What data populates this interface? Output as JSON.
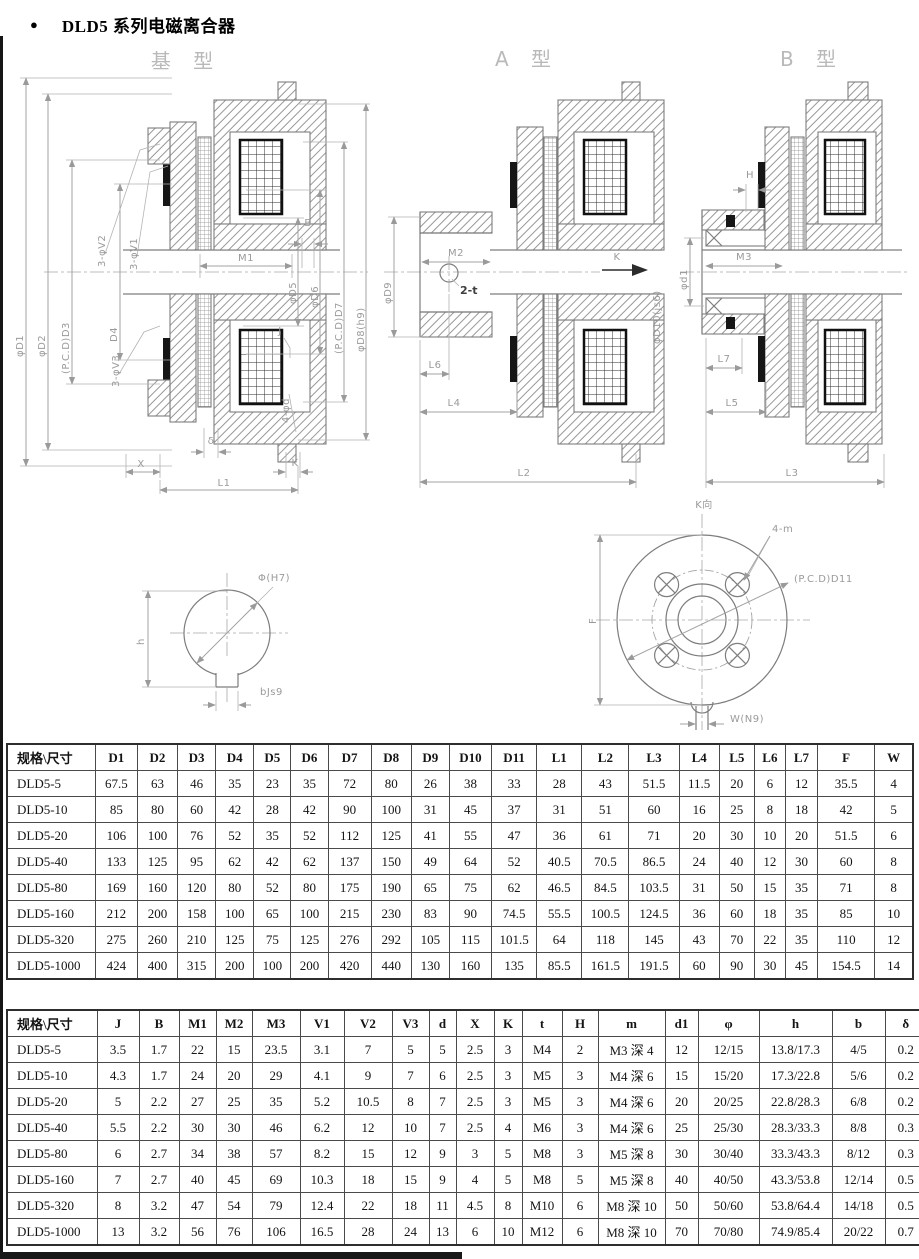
{
  "page": {
    "bullet": "●",
    "title": "DLD5 系列电磁离合器"
  },
  "drawings": {
    "base": {
      "title": "基 型",
      "labels": {
        "phiD1": "φD1",
        "phiD2": "φD2",
        "pcdD3": "(P.C.D)D3",
        "D4": "D4",
        "v2": "3-φV2",
        "v1": "3-φV1",
        "B": "B",
        "M1": "M1",
        "phiD5": "φD5",
        "phiD6": "φD6",
        "pcdD7": "(P.C.D)D7",
        "phiD8": "φD8(h9)",
        "v3": "3-φV3",
        "phid": "4-φd",
        "delta": "δ",
        "X": "X",
        "L1": "L1",
        "K": "K",
        "J": "J"
      }
    },
    "typeA": {
      "title": "A 型",
      "labels": {
        "M2": "M2",
        "phiD9": "φD9",
        "t2": "2-t",
        "L6": "L6",
        "L4": "L4",
        "L2": "L2",
        "K": "K",
        "phiD10": "φD10(js6)"
      }
    },
    "typeB": {
      "title": "B 型",
      "labels": {
        "H": "H",
        "M3": "M3",
        "phid1": "φd1",
        "L7": "L7",
        "L5": "L5",
        "L3": "L3"
      }
    },
    "bore": {
      "labels": {
        "phiH7": "Φ(H7)",
        "h": "h",
        "b": "bJs9"
      }
    },
    "flange": {
      "labels": {
        "view": "K向",
        "m4": "4-m",
        "pcdD11": "(P.C.D)D11",
        "F": "F",
        "W": "W(N9)"
      }
    }
  },
  "table1": {
    "headers": [
      "规格\\尺寸",
      "D1",
      "D2",
      "D3",
      "D4",
      "D5",
      "D6",
      "D7",
      "D8",
      "D9",
      "D10",
      "D11",
      "L1",
      "L2",
      "L3",
      "L4",
      "L5",
      "L6",
      "L7",
      "F",
      "W"
    ],
    "rows": [
      [
        "DLD5-5",
        "67.5",
        "63",
        "46",
        "35",
        "23",
        "35",
        "72",
        "80",
        "26",
        "38",
        "33",
        "28",
        "43",
        "51.5",
        "11.5",
        "20",
        "6",
        "12",
        "35.5",
        "4"
      ],
      [
        "DLD5-10",
        "85",
        "80",
        "60",
        "42",
        "28",
        "42",
        "90",
        "100",
        "31",
        "45",
        "37",
        "31",
        "51",
        "60",
        "16",
        "25",
        "8",
        "18",
        "42",
        "5"
      ],
      [
        "DLD5-20",
        "106",
        "100",
        "76",
        "52",
        "35",
        "52",
        "112",
        "125",
        "41",
        "55",
        "47",
        "36",
        "61",
        "71",
        "20",
        "30",
        "10",
        "20",
        "51.5",
        "6"
      ],
      [
        "DLD5-40",
        "133",
        "125",
        "95",
        "62",
        "42",
        "62",
        "137",
        "150",
        "49",
        "64",
        "52",
        "40.5",
        "70.5",
        "86.5",
        "24",
        "40",
        "12",
        "30",
        "60",
        "8"
      ],
      [
        "DLD5-80",
        "169",
        "160",
        "120",
        "80",
        "52",
        "80",
        "175",
        "190",
        "65",
        "75",
        "62",
        "46.5",
        "84.5",
        "103.5",
        "31",
        "50",
        "15",
        "35",
        "71",
        "8"
      ],
      [
        "DLD5-160",
        "212",
        "200",
        "158",
        "100",
        "65",
        "100",
        "215",
        "230",
        "83",
        "90",
        "74.5",
        "55.5",
        "100.5",
        "124.5",
        "36",
        "60",
        "18",
        "35",
        "85",
        "10"
      ],
      [
        "DLD5-320",
        "275",
        "260",
        "210",
        "125",
        "75",
        "125",
        "276",
        "292",
        "105",
        "115",
        "101.5",
        "64",
        "118",
        "145",
        "43",
        "70",
        "22",
        "35",
        "110",
        "12"
      ],
      [
        "DLD5-1000",
        "424",
        "400",
        "315",
        "200",
        "100",
        "200",
        "420",
        "440",
        "130",
        "160",
        "135",
        "85.5",
        "161.5",
        "191.5",
        "60",
        "90",
        "30",
        "45",
        "154.5",
        "14"
      ]
    ]
  },
  "table2": {
    "headers": [
      "规格\\尺寸",
      "J",
      "B",
      "M1",
      "M2",
      "M3",
      "V1",
      "V2",
      "V3",
      "d",
      "X",
      "K",
      "t",
      "H",
      "m",
      "d1",
      "φ",
      "h",
      "b",
      "δ"
    ],
    "rows": [
      [
        "DLD5-5",
        "3.5",
        "1.7",
        "22",
        "15",
        "23.5",
        "3.1",
        "7",
        "5",
        "5",
        "2.5",
        "3",
        "M4",
        "2",
        "M3 深 4",
        "12",
        "12/15",
        "13.8/17.3",
        "4/5",
        "0.2"
      ],
      [
        "DLD5-10",
        "4.3",
        "1.7",
        "24",
        "20",
        "29",
        "4.1",
        "9",
        "7",
        "6",
        "2.5",
        "3",
        "M5",
        "3",
        "M4 深 6",
        "15",
        "15/20",
        "17.3/22.8",
        "5/6",
        "0.2"
      ],
      [
        "DLD5-20",
        "5",
        "2.2",
        "27",
        "25",
        "35",
        "5.2",
        "10.5",
        "8",
        "7",
        "2.5",
        "3",
        "M5",
        "3",
        "M4 深 6",
        "20",
        "20/25",
        "22.8/28.3",
        "6/8",
        "0.2"
      ],
      [
        "DLD5-40",
        "5.5",
        "2.2",
        "30",
        "30",
        "46",
        "6.2",
        "12",
        "10",
        "7",
        "2.5",
        "4",
        "M6",
        "3",
        "M4 深 6",
        "25",
        "25/30",
        "28.3/33.3",
        "8/8",
        "0.3"
      ],
      [
        "DLD5-80",
        "6",
        "2.7",
        "34",
        "38",
        "57",
        "8.2",
        "15",
        "12",
        "9",
        "3",
        "5",
        "M8",
        "3",
        "M5 深 8",
        "30",
        "30/40",
        "33.3/43.3",
        "8/12",
        "0.3"
      ],
      [
        "DLD5-160",
        "7",
        "2.7",
        "40",
        "45",
        "69",
        "10.3",
        "18",
        "15",
        "9",
        "4",
        "5",
        "M8",
        "5",
        "M5 深 8",
        "40",
        "40/50",
        "43.3/53.8",
        "12/14",
        "0.5"
      ],
      [
        "DLD5-320",
        "8",
        "3.2",
        "47",
        "54",
        "79",
        "12.4",
        "22",
        "18",
        "11",
        "4.5",
        "8",
        "M10",
        "6",
        "M8 深 10",
        "50",
        "50/60",
        "53.8/64.4",
        "14/18",
        "0.5"
      ],
      [
        "DLD5-1000",
        "13",
        "3.2",
        "56",
        "76",
        "106",
        "16.5",
        "28",
        "24",
        "13",
        "6",
        "10",
        "M12",
        "6",
        "M8 深 10",
        "70",
        "70/80",
        "74.9/85.4",
        "20/22",
        "0.7"
      ]
    ]
  }
}
